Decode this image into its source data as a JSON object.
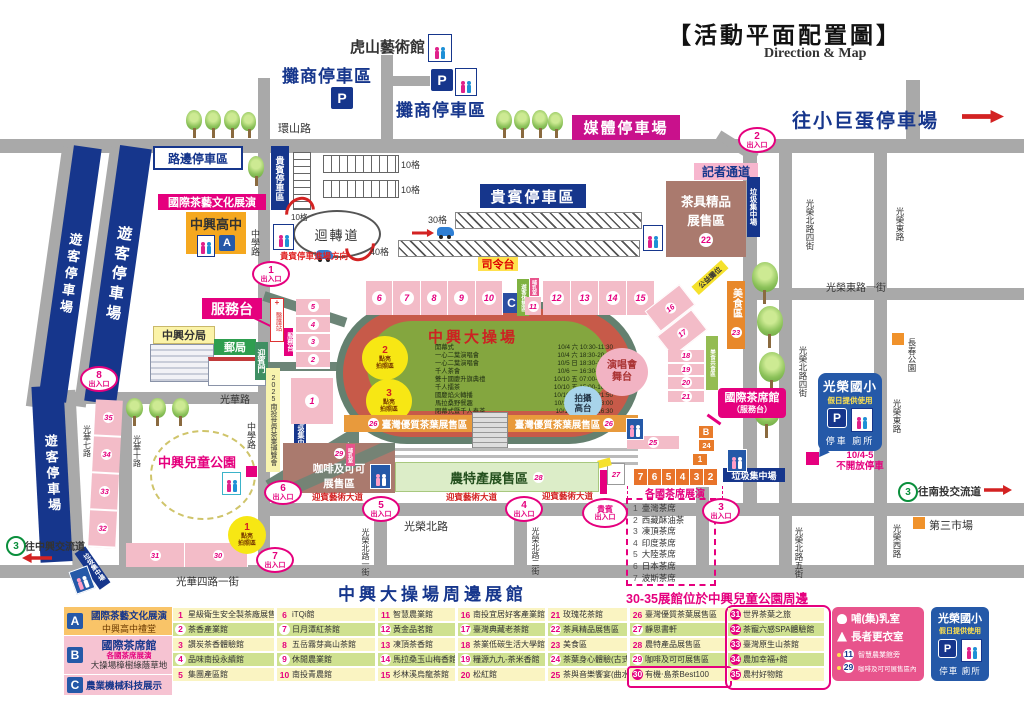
{
  "header": {
    "title": "【活動平面配置圖】",
    "subtitle": "Direction & Map",
    "to_dome": "往小巨蛋停車場",
    "to_nantou": "往南投交流道",
    "to_zhongxing": "往中興交流道",
    "hwy": "3"
  },
  "parking": {
    "visitor": "遊客停車場",
    "roadside": "路邊停車區",
    "vendor": "攤商停車區",
    "vip_box": "貴賓停車區",
    "vip_tag": "貴賓停車區",
    "media": "媒體停車場",
    "g10": "10格",
    "g30": "30格",
    "g40": "40格",
    "loop": "迴轉道",
    "vip_dir": "貴賓停車進場方向",
    "p": "P"
  },
  "roads": {
    "huanshan": "環山路",
    "zhongxue": "中學路",
    "guanghua": "光華路",
    "guanghua7": "光華七路",
    "guanghua10": "光華十路",
    "guanghua41": "光華四路一街",
    "gr_north": "光榮北路",
    "gn1": "光榮北路一街",
    "gn2": "光榮北路二街",
    "gn4": "光榮北路四街",
    "gn5": "光榮北路五街",
    "ge": "光榮東路",
    "ge1": "光榮東路一街",
    "gw": "光榮西路"
  },
  "places": {
    "hushan": "虎山藝術館",
    "label_a": "國際茶藝文化展演",
    "school": "中興高中",
    "police": "中興分局",
    "post": "郵局",
    "gate": "迎賓門",
    "service": "服務台",
    "medic": "醫護站",
    "trash": "垃圾集中場",
    "expo": "2025南投世界茶業博覽會",
    "park": "中興兒童公園",
    "changchun": "長春公園",
    "market": "第三市場",
    "press": "記者通道",
    "teaware1": "茶具精品",
    "teaware2": "展售區",
    "food": "美食區",
    "food_share": "美食共食區",
    "charity": "公益攤位",
    "rest": "遊客休憩區",
    "nursing": "哺乳室",
    "coffee1": "咖啡及可可",
    "coffee2": "展售區",
    "agri": "農特產展售區",
    "avenue": "迎賓藝術大道",
    "tea_hall1": "國際茶席館",
    "tea_hall2": "（服務台）",
    "perform": "各國茶席展演",
    "stage1": "演唱會",
    "stage2": "舞台",
    "camera1": "拍攝",
    "camera2": "高台",
    "cmd": "司令台",
    "strip26": "臺灣優質茶葉展售區",
    "photo1": "點亮",
    "photo2": "拍照區",
    "field": "中興大操場",
    "no_park1": "10/4-5",
    "no_park2": "不開放停車"
  },
  "gates": {
    "label": "出入口",
    "vip": "貴賓",
    "n1": "1",
    "n2": "2",
    "n3": "3",
    "n4": "4",
    "n5": "5",
    "n6": "6",
    "n7": "7",
    "n8": "8"
  },
  "schedule": [
    {
      "n": "開幕式",
      "t": "10/4 六 10:30-11:30"
    },
    {
      "n": "一心二葉演唱會",
      "t": "10/4 六 18:30-20:00"
    },
    {
      "n": "一心二葉演唱會",
      "t": "10/5 日 18:30-20:00"
    },
    {
      "n": "千人茶會",
      "t": "10/6 一 16:30-17:30"
    },
    {
      "n": "雙十國慶升旗典禮",
      "t": "10/10 五 07:00-08:00"
    },
    {
      "n": "千人擂茶",
      "t": "10/10 五 15:00-16:30"
    },
    {
      "n": "國慶焰火轉播",
      "t": "10/10 五 17:00-21:50"
    },
    {
      "n": "馬拉桑野餐趣",
      "t": "10/11 六 15:00-18:00"
    },
    {
      "n": "閉幕式暨千人奉茶",
      "t": "10/12日 15:00-16:30"
    }
  ],
  "tea_list": [
    {
      "n": "1",
      "t": "臺灣茶席"
    },
    {
      "n": "2",
      "t": "西藏酥油茶"
    },
    {
      "n": "3",
      "t": "凍頂茶席"
    },
    {
      "n": "4",
      "t": "印度茶席"
    },
    {
      "n": "5",
      "t": "大陸茶席"
    },
    {
      "n": "6",
      "t": "日本茶席"
    },
    {
      "n": "7",
      "t": "波斯茶席"
    }
  ],
  "booths": {
    "rowA": [
      "6",
      "7",
      "8",
      "9",
      "10"
    ],
    "rowB": [
      "12",
      "13",
      "14",
      "15"
    ],
    "left": [
      "5",
      "4",
      "3",
      "2"
    ],
    "right": [
      "18",
      "19",
      "20",
      "21"
    ],
    "diag1": "16",
    "diag2": "17",
    "orange": [
      "7",
      "6",
      "5",
      "4",
      "3",
      "2"
    ],
    "pcol": [
      "35",
      "34",
      "33",
      "32"
    ],
    "prow": [
      "31",
      "30"
    ],
    "one": "1",
    "one_s": "1",
    "c": "C",
    "b": "B",
    "a": "A",
    "n11": "11",
    "n22": "22",
    "n23": "23",
    "n24": "24",
    "n25": "25",
    "n26": "26",
    "n27": "27",
    "n28": "28",
    "n29": "29"
  },
  "titles": {
    "around": "中興大操場周邊展館",
    "note3035": "30-35展館位於中興兒童公園周邊"
  },
  "legend": {
    "a": {
      "k": "A",
      "l1": "國際茶藝文化展演",
      "l2": "中興高中禮堂"
    },
    "b": {
      "k": "B",
      "l1": "國際茶席館",
      "l2": "各國茶席展演",
      "l3": "大操場樟樹綠蔭草地"
    },
    "c": {
      "k": "C",
      "l1": "農業機械科技展示"
    },
    "cols": [
      [
        {
          "n": "1",
          "t": "星級衛生安全製茶廠展售館"
        },
        {
          "n": "2",
          "t": "茶香產業館"
        },
        {
          "n": "3",
          "t": "讚炭茶香體驗館"
        },
        {
          "n": "4",
          "t": "品味南投永續館"
        },
        {
          "n": "5",
          "t": "集團產區館"
        }
      ],
      [
        {
          "n": "6",
          "t": "iTQi館"
        },
        {
          "n": "7",
          "t": "日月潭紅茶館"
        },
        {
          "n": "8",
          "t": "五岳霧芽高山茶館"
        },
        {
          "n": "9",
          "t": "休閒農業館"
        },
        {
          "n": "10",
          "t": "南投青農館"
        }
      ],
      [
        {
          "n": "11",
          "t": "智慧農業館"
        },
        {
          "n": "12",
          "t": "黃金品茗館"
        },
        {
          "n": "13",
          "t": "凍頂茶香館"
        },
        {
          "n": "14",
          "t": "馬拉桑玉山梅香館"
        },
        {
          "n": "15",
          "t": "杉林溪烏龍茶館"
        }
      ],
      [
        {
          "n": "16",
          "t": "南投宜居好客產業館"
        },
        {
          "n": "17",
          "t": "臺灣典藏老茶館"
        },
        {
          "n": "18",
          "t": "茶業低碳生活大學館"
        },
        {
          "n": "19",
          "t": "糧源九九-茶米香館"
        },
        {
          "n": "20",
          "t": "松紅館"
        }
      ],
      [
        {
          "n": "21",
          "t": "玫瑰花茶館"
        },
        {
          "n": "22",
          "t": "茶具精品展售區"
        },
        {
          "n": "23",
          "t": "美食區"
        },
        {
          "n": "24",
          "t": "茶葉身心體驗(古式奶茶)"
        },
        {
          "n": "25",
          "t": "茶與音樂饗宴(曲水流觴)"
        }
      ],
      [
        {
          "n": "26",
          "t": "臺灣優質茶葉展售區"
        },
        {
          "n": "27",
          "t": "靜思書軒"
        },
        {
          "n": "28",
          "t": "農特產品展售區"
        },
        {
          "n": "29",
          "t": "咖啡及可可展售區"
        },
        {
          "n": "30",
          "t": "有機‧島茶Best100",
          "d": true
        }
      ],
      [
        {
          "n": "31",
          "t": "世界茶葉之旅",
          "d": true
        },
        {
          "n": "32",
          "t": "茶寵六感SPA體驗館",
          "d": true
        },
        {
          "n": "33",
          "t": "臺灣原生山茶館",
          "d": true
        },
        {
          "n": "34",
          "t": "農加幸福+館",
          "d": true
        },
        {
          "n": "35",
          "t": "農村好物館",
          "d": true
        }
      ]
    ]
  },
  "info": {
    "nursing": "哺(集)乳室",
    "elder": "長者更衣室",
    "n1": "11",
    "t1": "智慧農業館旁",
    "n2": "29",
    "t2": "咖啡及可可展售區內"
  },
  "school_box": {
    "name": "光榮國小",
    "sub": "假日提供使用",
    "park": "停車",
    "wc": "廁所"
  }
}
